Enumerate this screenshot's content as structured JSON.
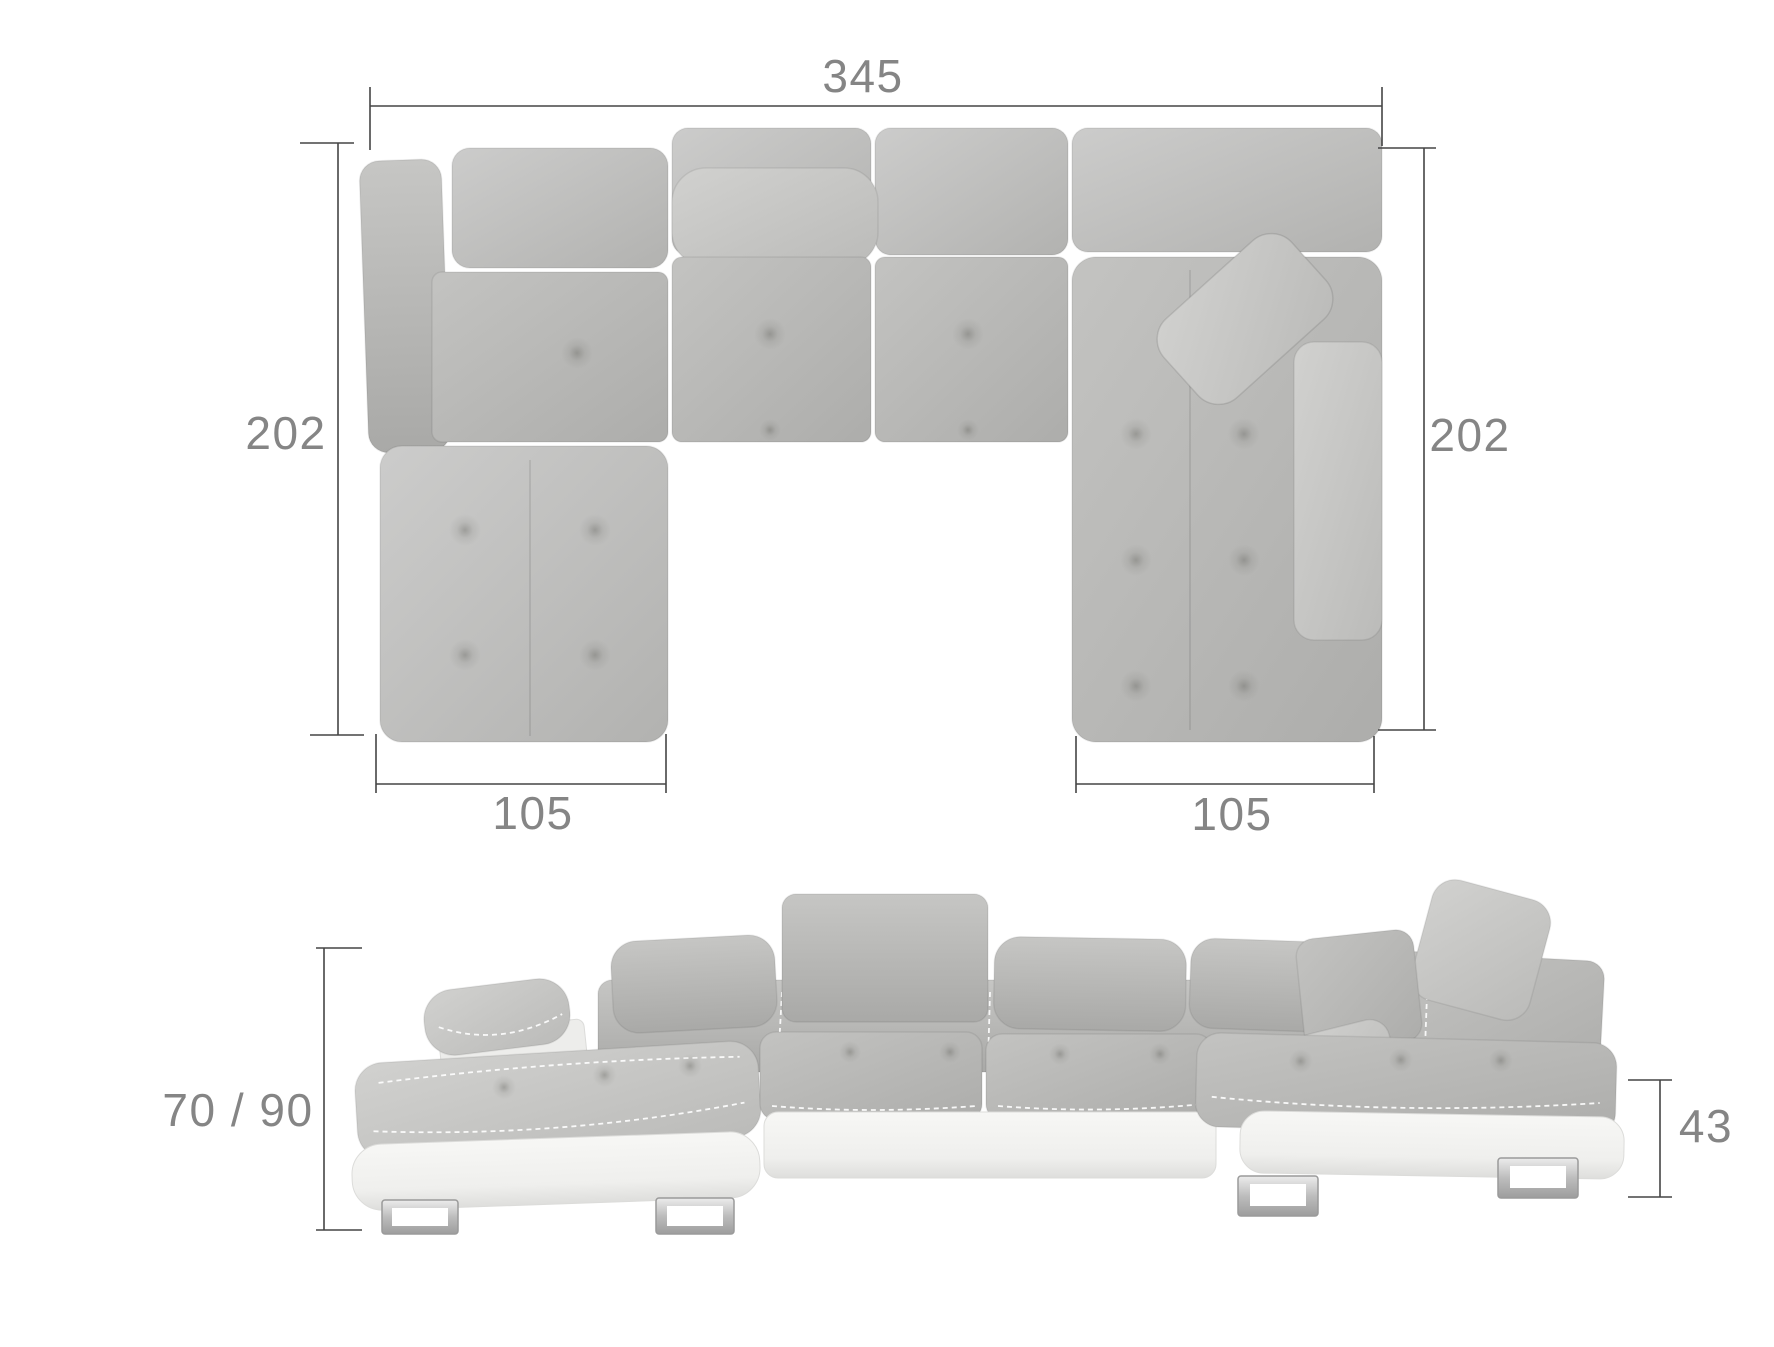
{
  "diagram": {
    "background": "#ffffff",
    "colors": {
      "dimension_line": "#454545",
      "dimension_text": "#858585",
      "fabric_light": "#cbcbc9",
      "fabric_mid": "#b8b8b6",
      "fabric_dark": "#a7a7a5",
      "base_white": "#f4f4f2",
      "chrome_leg": "#c9c9c9"
    },
    "views": {
      "top_view": {
        "dimensions": {
          "overall_width": "345",
          "left_side_depth": "202",
          "right_side_depth": "202",
          "left_chaise_width": "105",
          "right_chaise_width": "105"
        }
      },
      "front_view": {
        "dimensions": {
          "height_range": "70 / 90",
          "base_height": "43"
        }
      }
    }
  }
}
